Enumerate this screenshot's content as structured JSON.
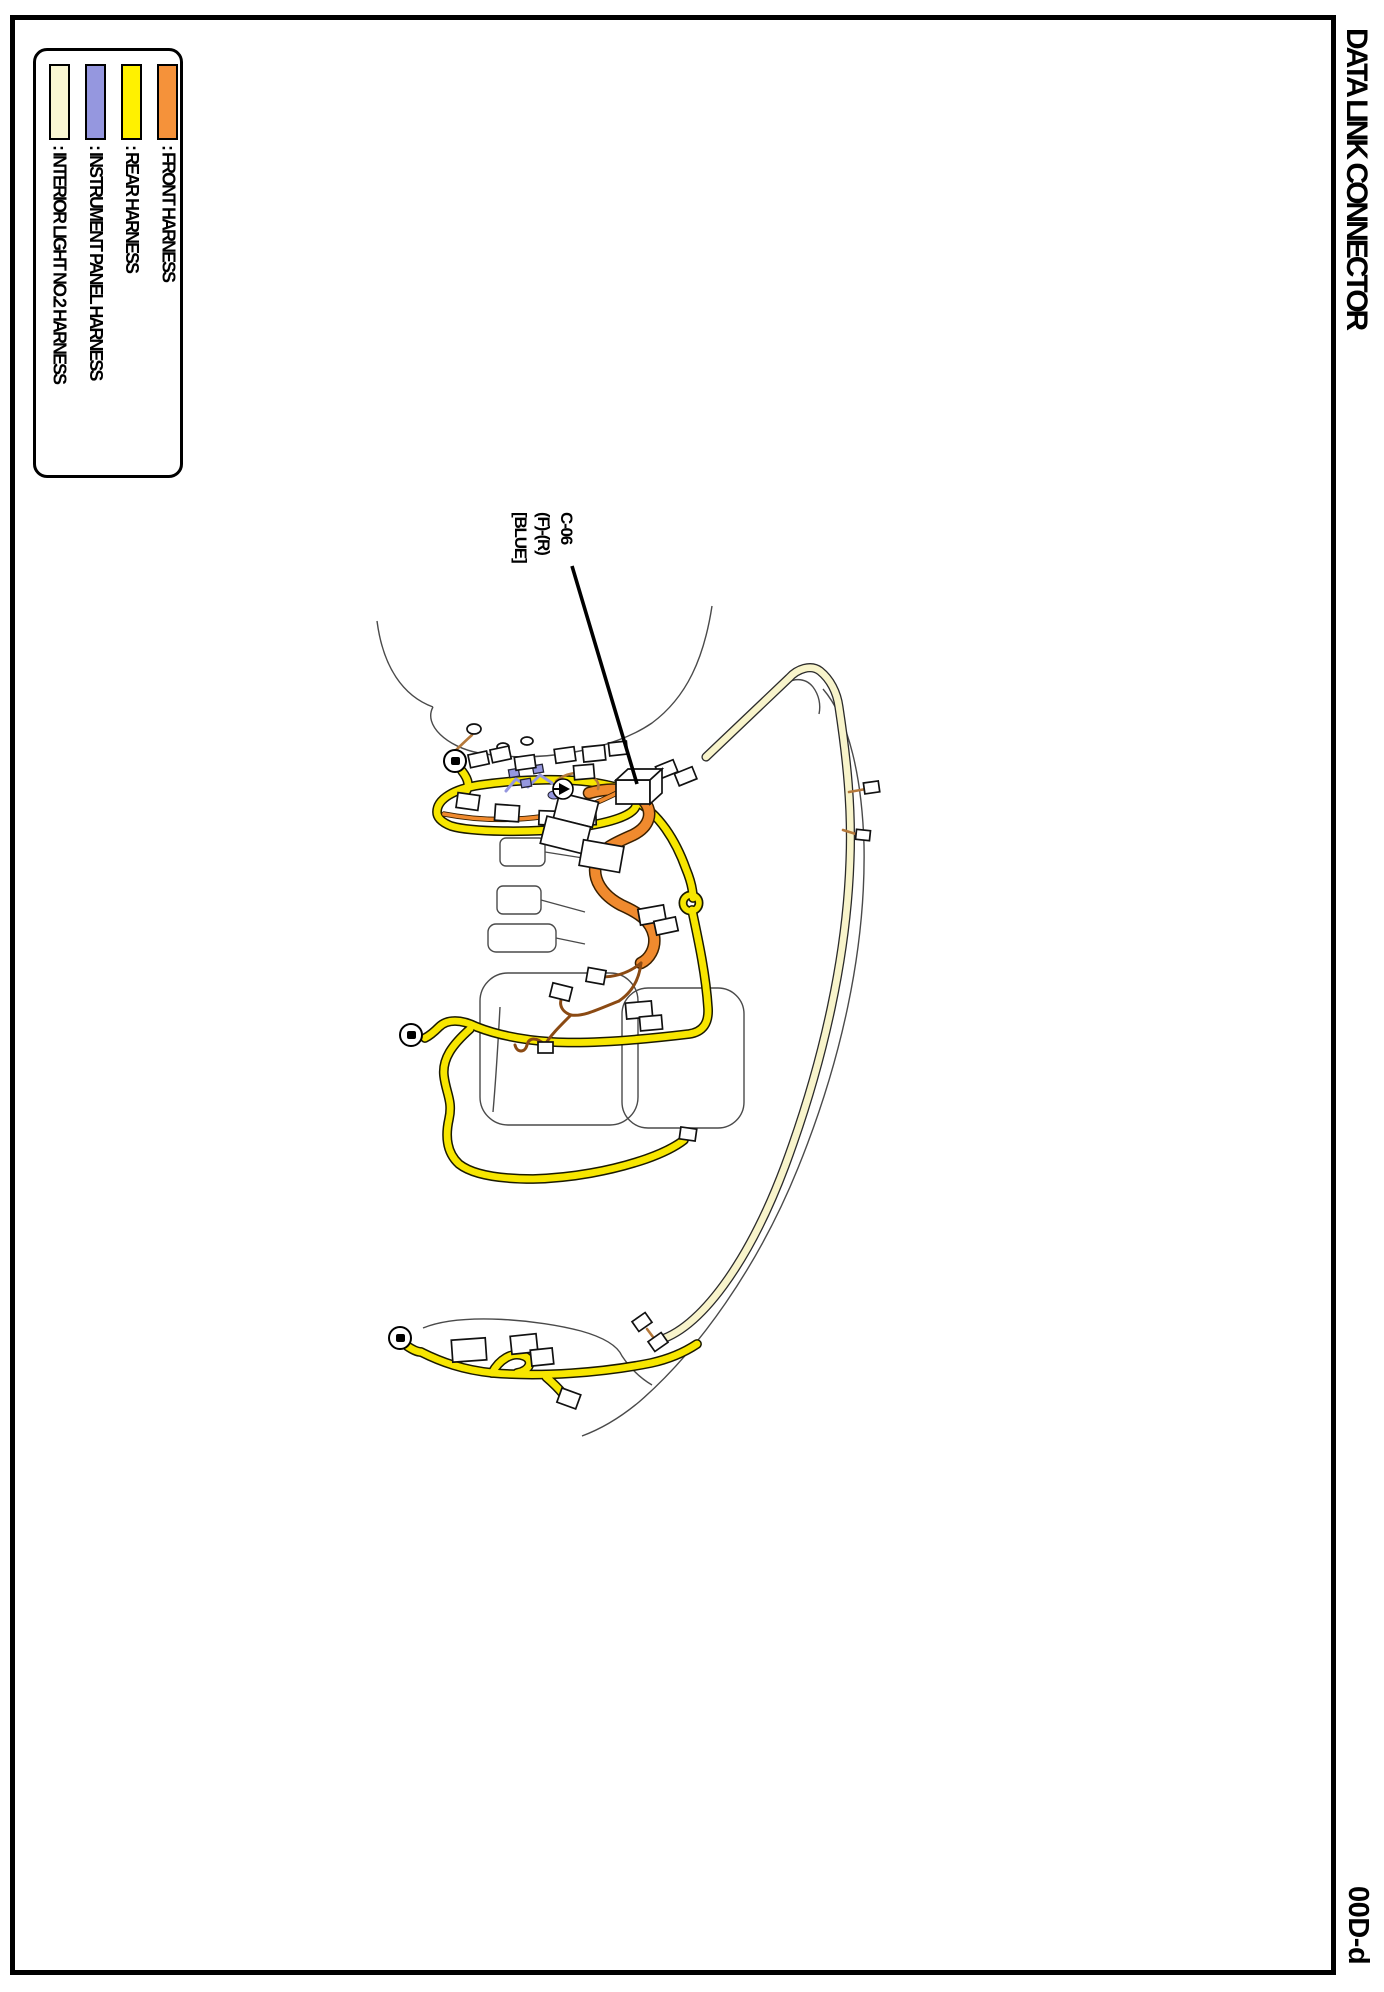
{
  "page": {
    "title": "DATA LINK CONNECTOR",
    "page_code": "00D-d"
  },
  "legend": {
    "items": [
      {
        "color": "#FAF7D2",
        "label": ": INTERIOR LIGHT NO.2 HARNESS"
      },
      {
        "color": "#9597DF",
        "label": ": INSTRUMENT PANEL HARNESS"
      },
      {
        "color": "#FFF100",
        "label": ": REAR HARNESS"
      },
      {
        "color": "#F5923A",
        "label": ": FRONT HARNESS"
      }
    ]
  },
  "callout": {
    "lines": [
      "C-06",
      "(F)-(R)",
      "[BLUE]"
    ]
  },
  "colors": {
    "body": "#4a4a4a",
    "cream": "#F8F4CB",
    "yellow": "#F7E600",
    "orange": "#F08A2E",
    "blue": "#9597DF",
    "brown": "#8B4A13",
    "tan": "#B5793B"
  }
}
